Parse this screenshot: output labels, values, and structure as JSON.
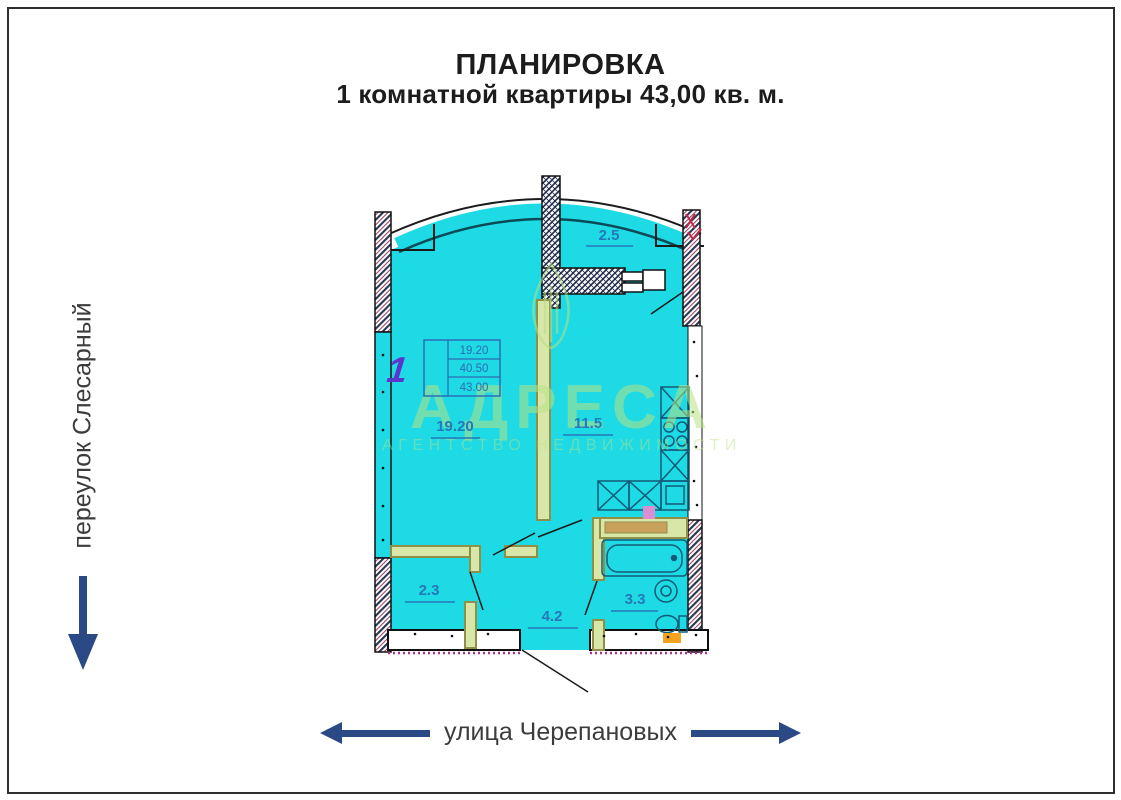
{
  "title": {
    "line1": "ПЛАНИРОВКА",
    "line2": "1 комнатной квартиры 43,00 кв. м."
  },
  "streets": {
    "left_label": "переулок Слесарный",
    "bottom_label": "улица Черепановых"
  },
  "plan": {
    "rooms": [
      {
        "name": "loggia",
        "area": "2.5"
      },
      {
        "name": "living",
        "area": "19.20"
      },
      {
        "name": "kitchen",
        "area": "11.5"
      },
      {
        "name": "wardrobe",
        "area": "2.3"
      },
      {
        "name": "hall",
        "area": "4.2"
      },
      {
        "name": "bathroom",
        "area": "3.3"
      }
    ],
    "stamp": {
      "rooms": "1",
      "living_area": "19.20",
      "total_area": "40.50",
      "total_with_balcony": "43.00"
    }
  },
  "watermark": {
    "name": "АДРЕСА",
    "subtitle": "АГЕНТСТВО НЕДВИЖИМОСТИ"
  },
  "colors": {
    "floor_fill": "#1edae4",
    "label_blue": "#2579b8",
    "stamp_blue": "#2d6cb5",
    "stamp_number_purple": "#5b35cc",
    "partition_olive": "#8f9048",
    "arrow_navy": "#2b4a85",
    "dotted_magenta": "#b0308a",
    "accent_red": "#c42848",
    "orange": "#f5a21c",
    "watermark_green": "#b7e283"
  }
}
